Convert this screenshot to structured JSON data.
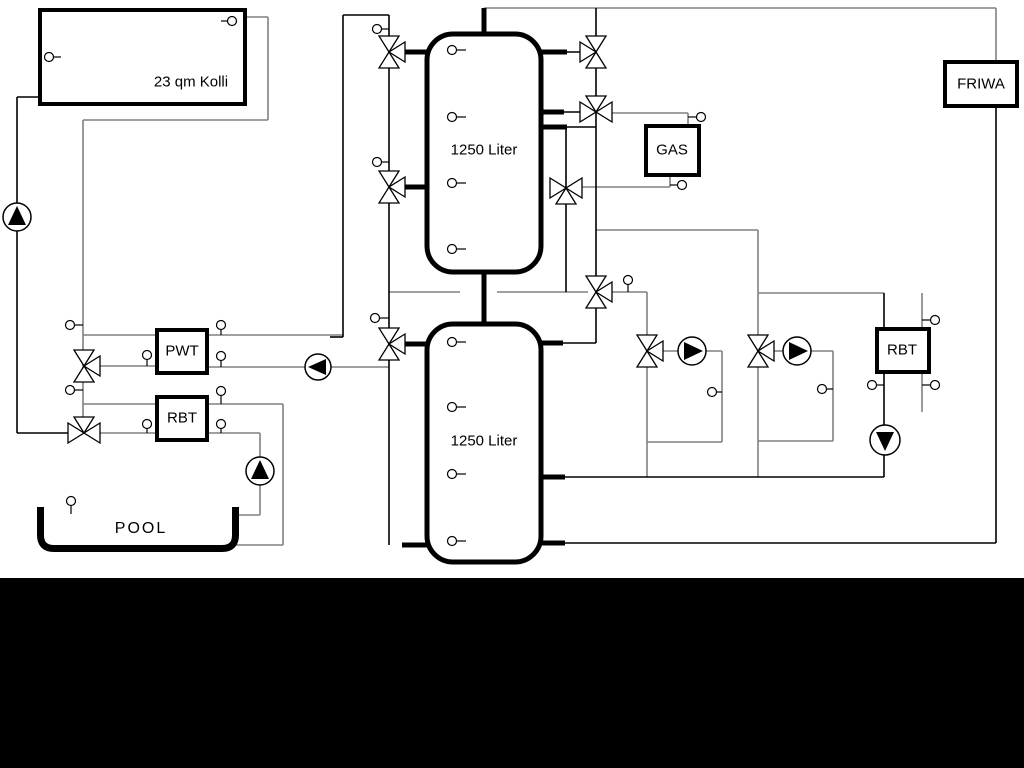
{
  "schematic": {
    "collector": {
      "label": "23 qm Kolli"
    },
    "buffer_tank_top": {
      "label": "1250 Liter"
    },
    "buffer_tank_bottom": {
      "label": "1250 Liter"
    },
    "heat_exchanger": {
      "label": "PWT"
    },
    "rbt_left": {
      "label": "RBT"
    },
    "rbt_right": {
      "label": "RBT"
    },
    "gas_boiler": {
      "label": "GAS"
    },
    "fresh_water_station": {
      "label": "FRIWA"
    },
    "pool": {
      "label": "POOL"
    },
    "colors": {
      "pipe_gray": "#808080",
      "pipe_black": "#000000",
      "background": "#ffffff",
      "footer_band": "#000000"
    }
  }
}
